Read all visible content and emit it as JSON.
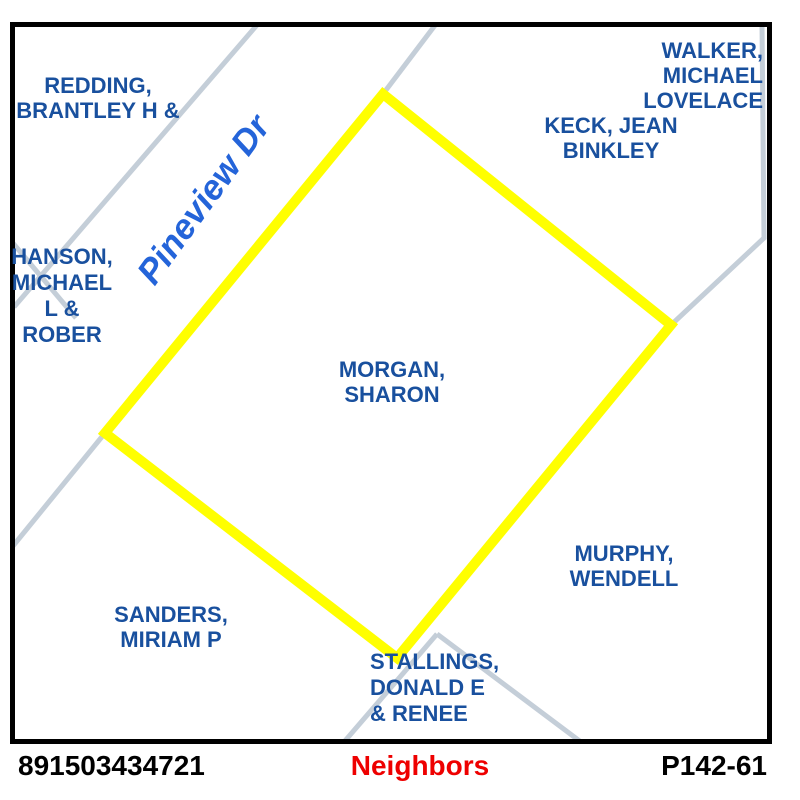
{
  "colors": {
    "parcel_highlight": "#FFFF00",
    "road_line": "#C4CED8",
    "owner_text": "#19509E",
    "road_label_text": "#2464D9",
    "footer_title_text": "#EE0000",
    "frame": "#000000"
  },
  "map": {
    "road_label": "Pineview Dr",
    "selected_parcel": {
      "owner": "MORGAN, SHARON",
      "label_lines": [
        "MORGAN,",
        "SHARON"
      ]
    },
    "neighbor_labels": {
      "redding": [
        "REDDING,",
        "BRANTLEY H &"
      ],
      "hanson": [
        "HANSON,",
        "MICHAEL",
        "L &",
        "ROBER"
      ],
      "walker": [
        "WALKER,",
        "MICHAEL",
        "LOVELACE"
      ],
      "keck": [
        "KECK, JEAN",
        "BINKLEY"
      ],
      "murphy": [
        "MURPHY,",
        "WENDELL"
      ],
      "sanders": [
        "SANDERS,",
        "MIRIAM P"
      ],
      "stallings": [
        "STALLINGS,",
        "DONALD E",
        "& RENEE"
      ]
    }
  },
  "footer": {
    "parcel_id": "891503434721",
    "title": "Neighbors",
    "page_ref": "P142-61"
  }
}
